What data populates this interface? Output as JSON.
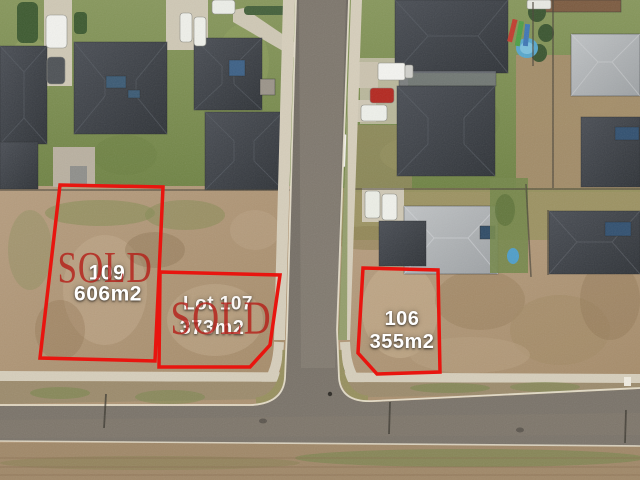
{
  "lots": [
    {
      "number": "109",
      "area": "606m2",
      "status": "SOLD"
    },
    {
      "number": "Lot 107",
      "area": "373m2",
      "status": "SOLD"
    },
    {
      "number": "106",
      "area": "355m2",
      "status": ""
    }
  ],
  "colors": {
    "lot_outline": "#e8150f",
    "sold_stamp": "#b5211a",
    "lot_label": "#ffffff"
  }
}
